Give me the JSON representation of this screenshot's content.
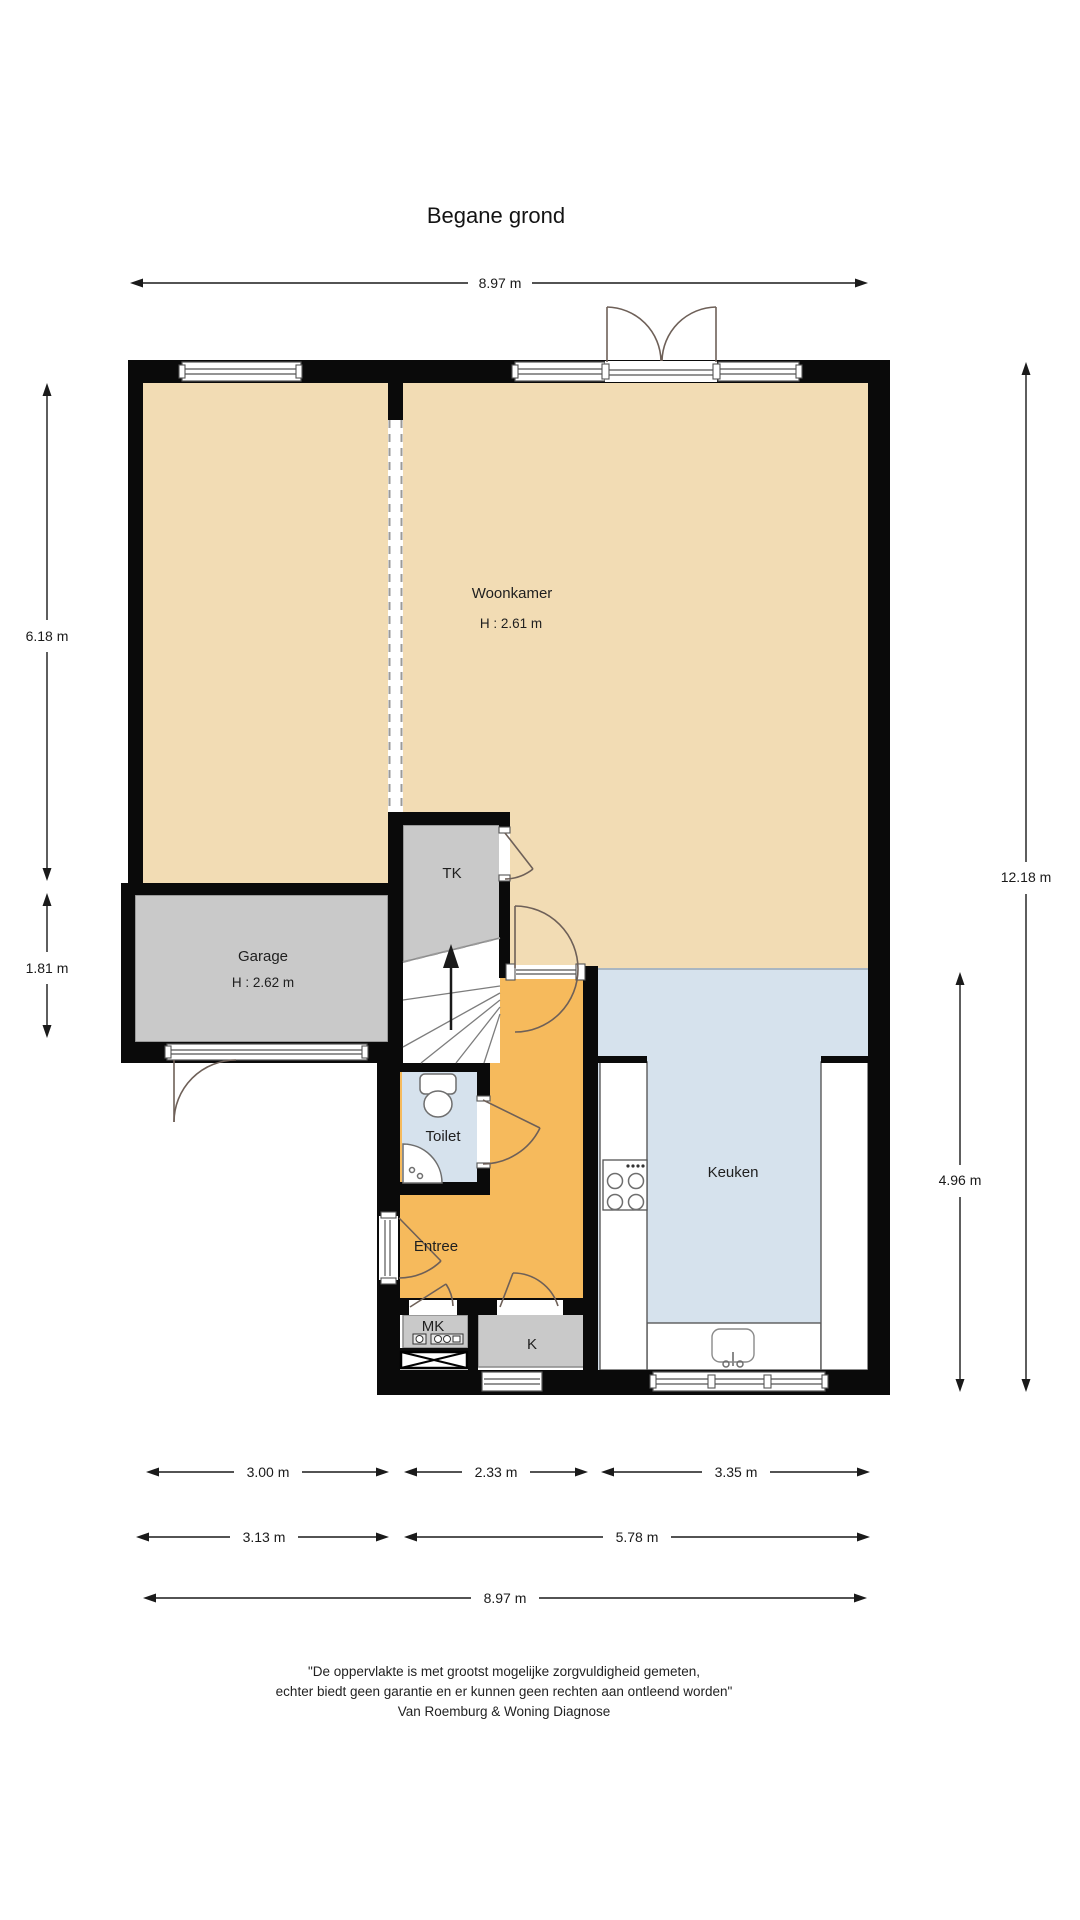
{
  "title": "Begane grond",
  "rooms": {
    "woonkamer": {
      "label": "Woonkamer",
      "height": "H : 2.61 m"
    },
    "garage": {
      "label": "Garage",
      "height": "H : 2.62 m"
    },
    "tk": {
      "label": "TK"
    },
    "toilet": {
      "label": "Toilet"
    },
    "entree": {
      "label": "Entree"
    },
    "keuken": {
      "label": "Keuken"
    },
    "mk": {
      "label": "MK"
    },
    "k": {
      "label": "K"
    }
  },
  "dimensions": {
    "top_width": "8.97 m",
    "left_upper": "6.18 m",
    "left_lower": "1.81 m",
    "right_total": "12.18 m",
    "right_kitchen": "4.96 m",
    "bottom_row1": [
      "3.00 m",
      "2.33 m",
      "3.35 m"
    ],
    "bottom_row2": [
      "3.13 m",
      "5.78 m"
    ],
    "bottom_total": "8.97 m"
  },
  "disclaimer": {
    "line1": "\"De oppervlakte is met grootst mogelijke zorgvuldigheid gemeten,",
    "line2": "echter biedt geen garantie en er kunnen geen rechten aan ontleend worden\"",
    "line3": "Van Roemburg & Woning Diagnose"
  },
  "colors": {
    "beige": "#F2DCB4",
    "gray": "#C9C9C9",
    "blue": "#D6E2ED",
    "orange": "#F6BA5C",
    "wall": "#0A0A0A",
    "dim": "#1A1A1A"
  }
}
